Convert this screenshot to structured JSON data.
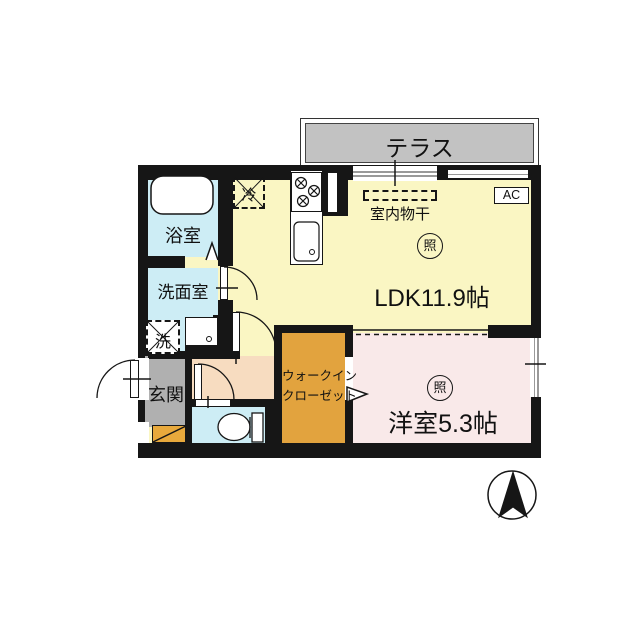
{
  "plan": {
    "terrace": {
      "label": "テラス"
    },
    "ldk": {
      "label": "LDK11.9帖",
      "light_label": "照"
    },
    "western_room": {
      "label": "洋室5.3帖",
      "light_label": "照"
    },
    "bathroom": {
      "label": "浴室"
    },
    "washroom": {
      "label": "洗面室"
    },
    "laundry": {
      "label": "洗"
    },
    "entrance": {
      "label": "玄関"
    },
    "refrigerator": {
      "label": "冷"
    },
    "indoor_drying": {
      "label": "室内物干"
    },
    "ac": {
      "label": "AC"
    },
    "wic": {
      "line1": "ウォークイン",
      "line2": "クローゼット"
    }
  },
  "colors": {
    "wall": "#161616",
    "ldk_fill": "#FAF6C3",
    "wet_room_fill": "#CDEDF5",
    "western_room_fill": "#F9E9E9",
    "wic_fill": "#E2A33E",
    "hallway_fill": "#F7DCC0",
    "entrance_fill": "#B0B0B0",
    "entrance_step_fill": "#E8A93C",
    "terrace_fill": "#C2C2C2"
  }
}
